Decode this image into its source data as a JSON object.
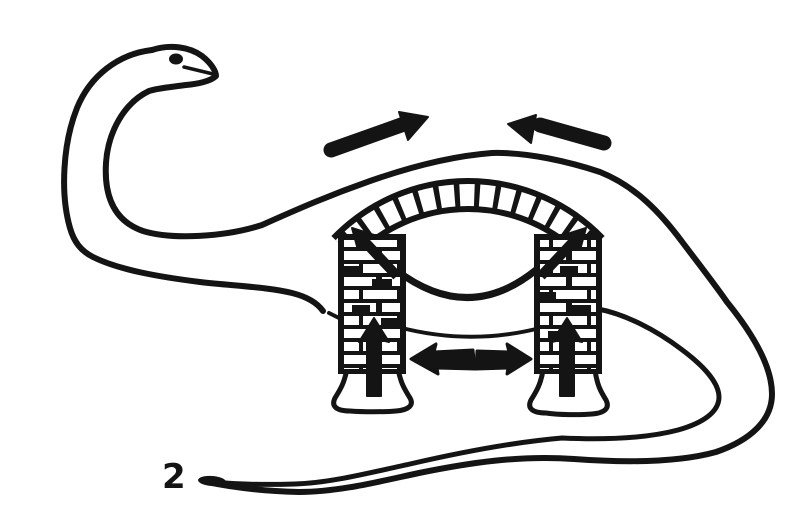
{
  "figure": {
    "label": "2",
    "ink_color": "#141414",
    "paper_color": "#ffffff",
    "subject": "Sauropod dinosaur drawn as a twin-pier masonry arch bridge",
    "arrows": [
      {
        "name": "top-left-compression-arrow",
        "direction": "up-right"
      },
      {
        "name": "top-right-compression-arrow",
        "direction": "up-left"
      },
      {
        "name": "left-pier-thrust-arrow",
        "direction": "up-left"
      },
      {
        "name": "right-pier-thrust-arrow",
        "direction": "up-right"
      },
      {
        "name": "mid-left-thrust-arrow",
        "direction": "left"
      },
      {
        "name": "mid-right-thrust-arrow",
        "direction": "right"
      },
      {
        "name": "left-foot-reaction-arrow",
        "direction": "up"
      },
      {
        "name": "right-foot-reaction-arrow",
        "direction": "up"
      }
    ]
  }
}
